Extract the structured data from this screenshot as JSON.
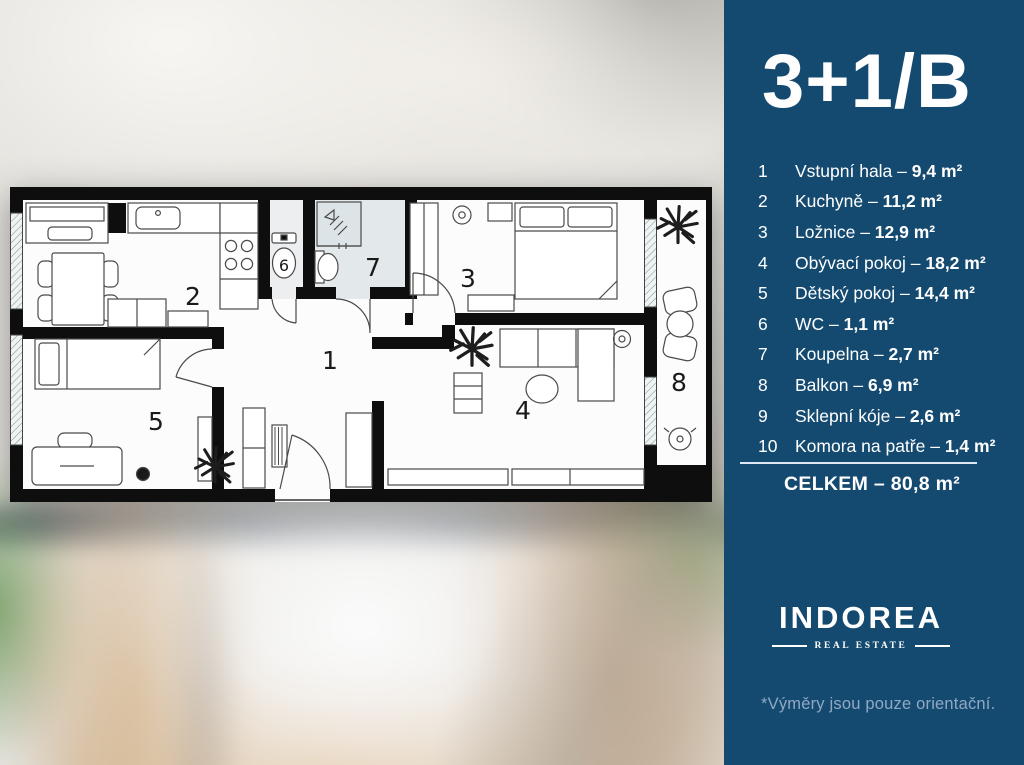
{
  "panel": {
    "background": "#154a70",
    "title": "3+1/B",
    "separator": " – ",
    "rooms": [
      {
        "num": "1",
        "name": "Vstupní hala",
        "area": "9,4 m²"
      },
      {
        "num": "2",
        "name": "Kuchyně",
        "area": "11,2 m²"
      },
      {
        "num": "3",
        "name": "Ložnice",
        "area": "12,9 m²"
      },
      {
        "num": "4",
        "name": "Obývací pokoj",
        "area": "18,2 m²"
      },
      {
        "num": "5",
        "name": "Dětský pokoj",
        "area": "14,4 m²"
      },
      {
        "num": "6",
        "name": "WC",
        "area": "1,1 m²"
      },
      {
        "num": "7",
        "name": "Koupelna",
        "area": "2,7 m²"
      },
      {
        "num": "8",
        "name": "Balkon",
        "area": "6,9 m²"
      },
      {
        "num": "9",
        "name": "Sklepní kóje",
        "area": "2,6 m²"
      },
      {
        "num": "10",
        "name": "Komora na patře",
        "area": "1,4 m²"
      }
    ],
    "total": "CELKEM – 80,8 m²",
    "brand": {
      "name": "INDOREA",
      "tagline": "REAL ESTATE"
    },
    "disclaimer": "*Výměry jsou pouze orientační.",
    "muted_color": "#8fa9c4"
  },
  "floor_plan": {
    "labels": [
      {
        "room": "vstupni-hala",
        "text": "1"
      },
      {
        "room": "kuchyne",
        "text": "2"
      },
      {
        "room": "loznice",
        "text": "3"
      },
      {
        "room": "obyvaci-pokoj",
        "text": "4"
      },
      {
        "room": "detsky-pokoj",
        "text": "5"
      },
      {
        "room": "wc",
        "text": "6"
      },
      {
        "room": "koupelna",
        "text": "7"
      },
      {
        "room": "balkon",
        "text": "8"
      }
    ]
  }
}
